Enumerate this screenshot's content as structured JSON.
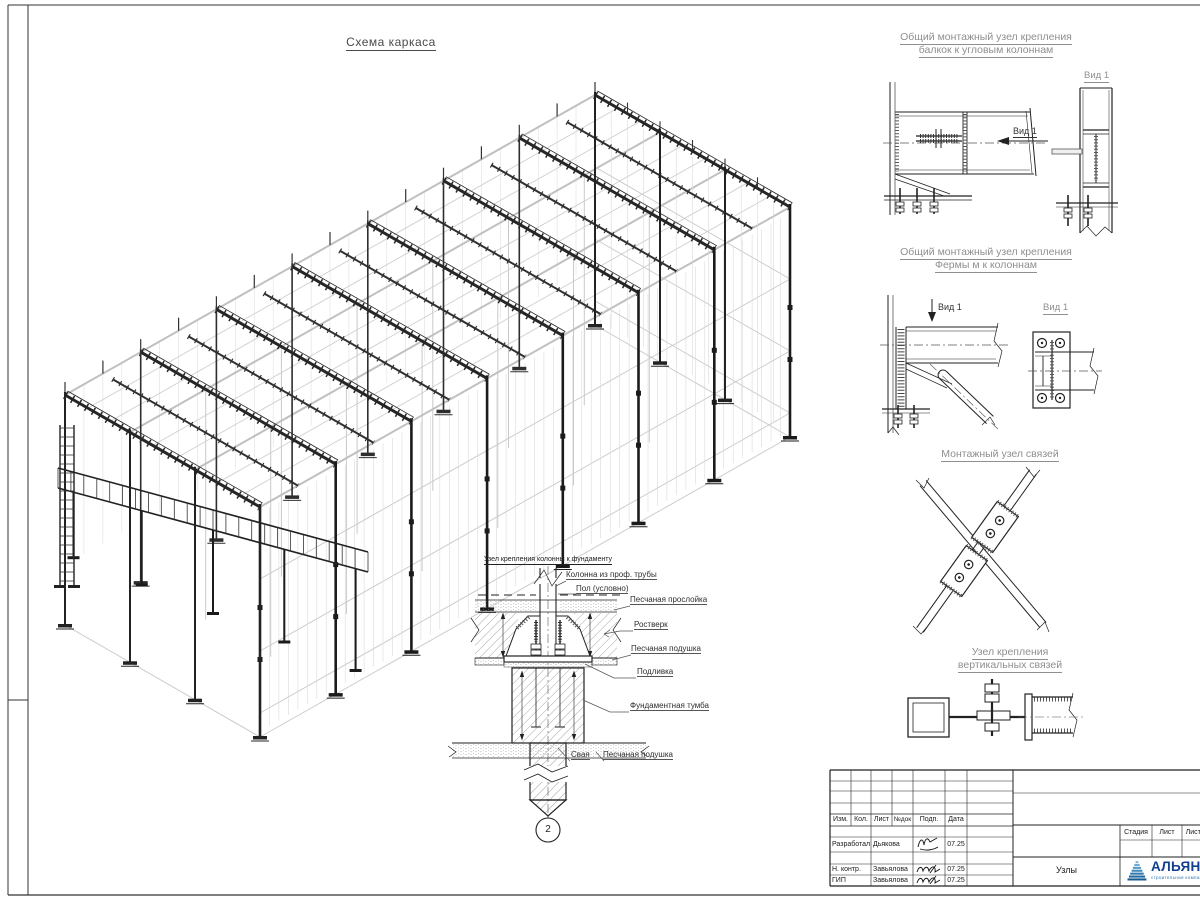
{
  "sheet": {
    "title": "Схема каркаса"
  },
  "details": {
    "d1": {
      "title1": "Общий монтажный узел крепления",
      "title2": "балкок к угловым колоннам",
      "view_arrow": "Вид 1",
      "view_title": "Вид 1"
    },
    "d2": {
      "title1": "Общий монтажный узел крепления",
      "title2": "Фермы м к колоннам",
      "view_arrow": "Вид 1",
      "view_title": "Вид 1"
    },
    "d3": {
      "title": "Монтажный узел связей"
    },
    "d4": {
      "title1": "Узел крепления",
      "title2": "вертикальных связей"
    }
  },
  "foundation": {
    "title": "Узел крепления колонны к фундаменту",
    "labels": {
      "column": "Колонна из проф. трубы",
      "floor": "Пол (условно)",
      "sand_layer": "Песчаная прослойка",
      "grillage": "Ростверк",
      "sand_cushion": "Песчаная подушка",
      "grout": "Подливка",
      "foundation_block": "Фундаментная тумба",
      "pile": "Свая",
      "sand_cushion2": "Песчаная подушка"
    },
    "marker": "2"
  },
  "titleblock": {
    "headers": {
      "izm": "Изм.",
      "kol": "Кол.",
      "list": "Лист",
      "ndok": "№док",
      "podp": "Подп.",
      "data": "Дата"
    },
    "rows": [
      {
        "role": "Разработал",
        "name": "Дьякова",
        "date": "07.25"
      },
      {
        "role": "Н. контр.",
        "name": "Завьялова",
        "date": "07.25"
      },
      {
        "role": "ГИП",
        "name": "Завьялова",
        "date": "07.25"
      }
    ],
    "stage": "Стадия",
    "sheet": "Лист",
    "sheets": "Листов",
    "doc_name": "Узлы",
    "logo": {
      "name": "АЛЬЯНС",
      "tagline": "строительная компания"
    }
  }
}
